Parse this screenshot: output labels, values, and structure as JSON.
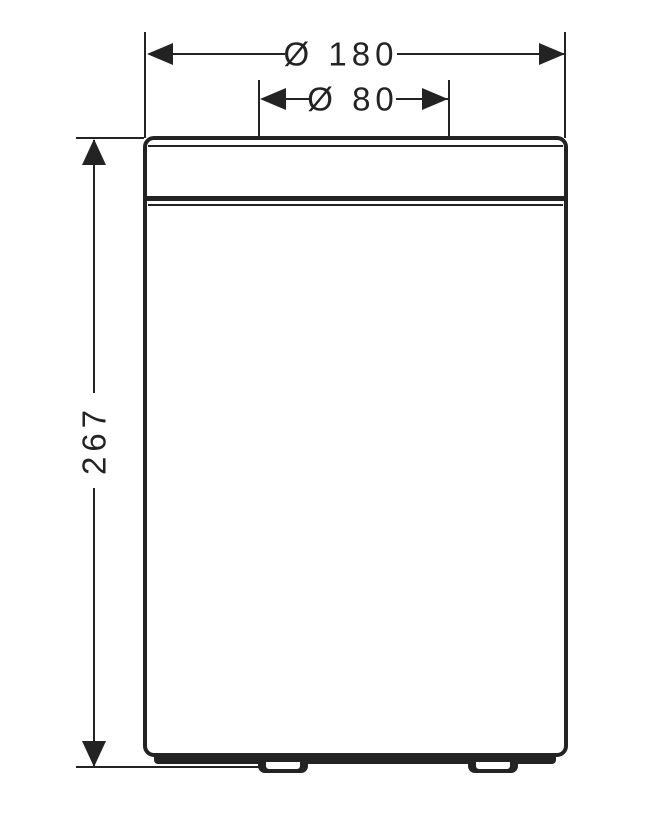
{
  "meta": {
    "title": "Waste bin dimensional drawing",
    "ink_color": "#232323",
    "paper_color": "#ffffff"
  },
  "dimensions": {
    "outer_diameter": {
      "label": "Ø 180",
      "value": 180
    },
    "opening_diameter": {
      "label": "Ø 80",
      "value": 80
    },
    "height": {
      "label": "267",
      "value": 267
    }
  }
}
